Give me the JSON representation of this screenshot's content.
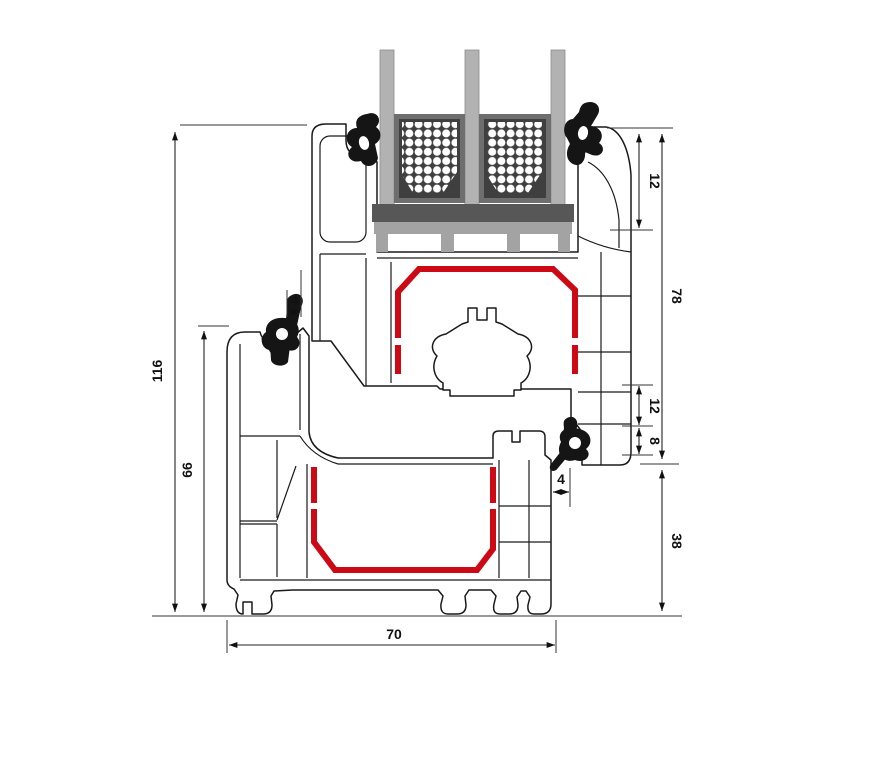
{
  "drawing": {
    "title": "window-frame-sash-cross-section",
    "dims": {
      "d116": "116",
      "d66": "66",
      "d4_top": "4",
      "d12_glazing": "12",
      "d78": "78",
      "d12_mid": "12",
      "d8": "8",
      "d4_bottom": "4",
      "d38": "38",
      "d70": "70"
    },
    "colors": {
      "reinforcement": "#cc0914",
      "gasket": "#151515",
      "glass": "#b2b2b2",
      "spacer_frame": "#6e6e6e",
      "spacer_fill": "#3f3f3f",
      "glazing_block": "#575757",
      "bridge": "#a3a3a3",
      "outline": "#1a1a1a",
      "dimension_line": "#222222"
    }
  }
}
